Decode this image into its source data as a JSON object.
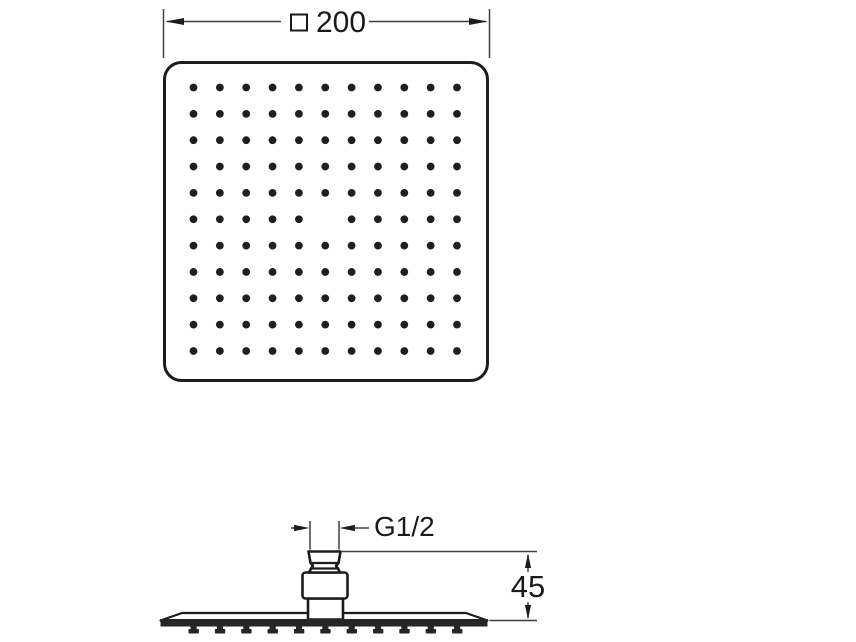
{
  "drawing": {
    "type": "technical-dimension-drawing",
    "subject": "square overhead rain shower head",
    "views": {
      "top_view": {
        "width_dimension": {
          "symbol": "□",
          "value": "200"
        },
        "spray_grid": {
          "rows": 11,
          "cols": 11,
          "missing_holes": [
            {
              "row": 6,
              "col": 6
            }
          ]
        }
      },
      "side_view": {
        "thread_dimension": {
          "label": "G1/2"
        },
        "height_dimension": {
          "value": "45"
        },
        "nozzle_count": 11
      }
    },
    "colors": {
      "line": "#1c1c1c",
      "thin_line": "#3f3f3f",
      "dot": "#1f1f1f",
      "dark_fill": "#262626",
      "text": "#1a1a1a",
      "background": "#ffffff"
    }
  }
}
